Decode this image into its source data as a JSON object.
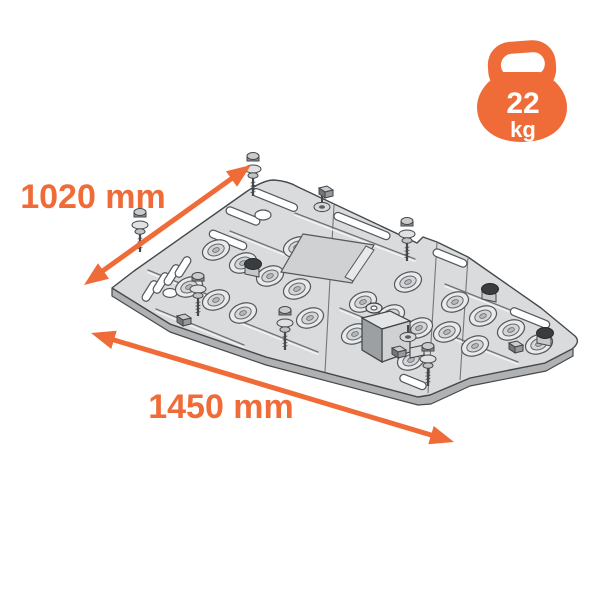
{
  "diagram": {
    "subject": "Skid plate (underbody protection) isometric exploded technical drawing with mounting bolts, washers and brackets",
    "width_label": "1020 mm",
    "length_label": "1450 mm"
  },
  "weight_badge": {
    "icon": "kettlebell-icon",
    "value": "22",
    "unit": "kg"
  },
  "colors": {
    "accent": "#EF6B38",
    "plate_fill": "#D9DBDC",
    "plate_edge": "#46494C",
    "badge_text": "#FFFFFF",
    "background": "#FFFFFF"
  }
}
